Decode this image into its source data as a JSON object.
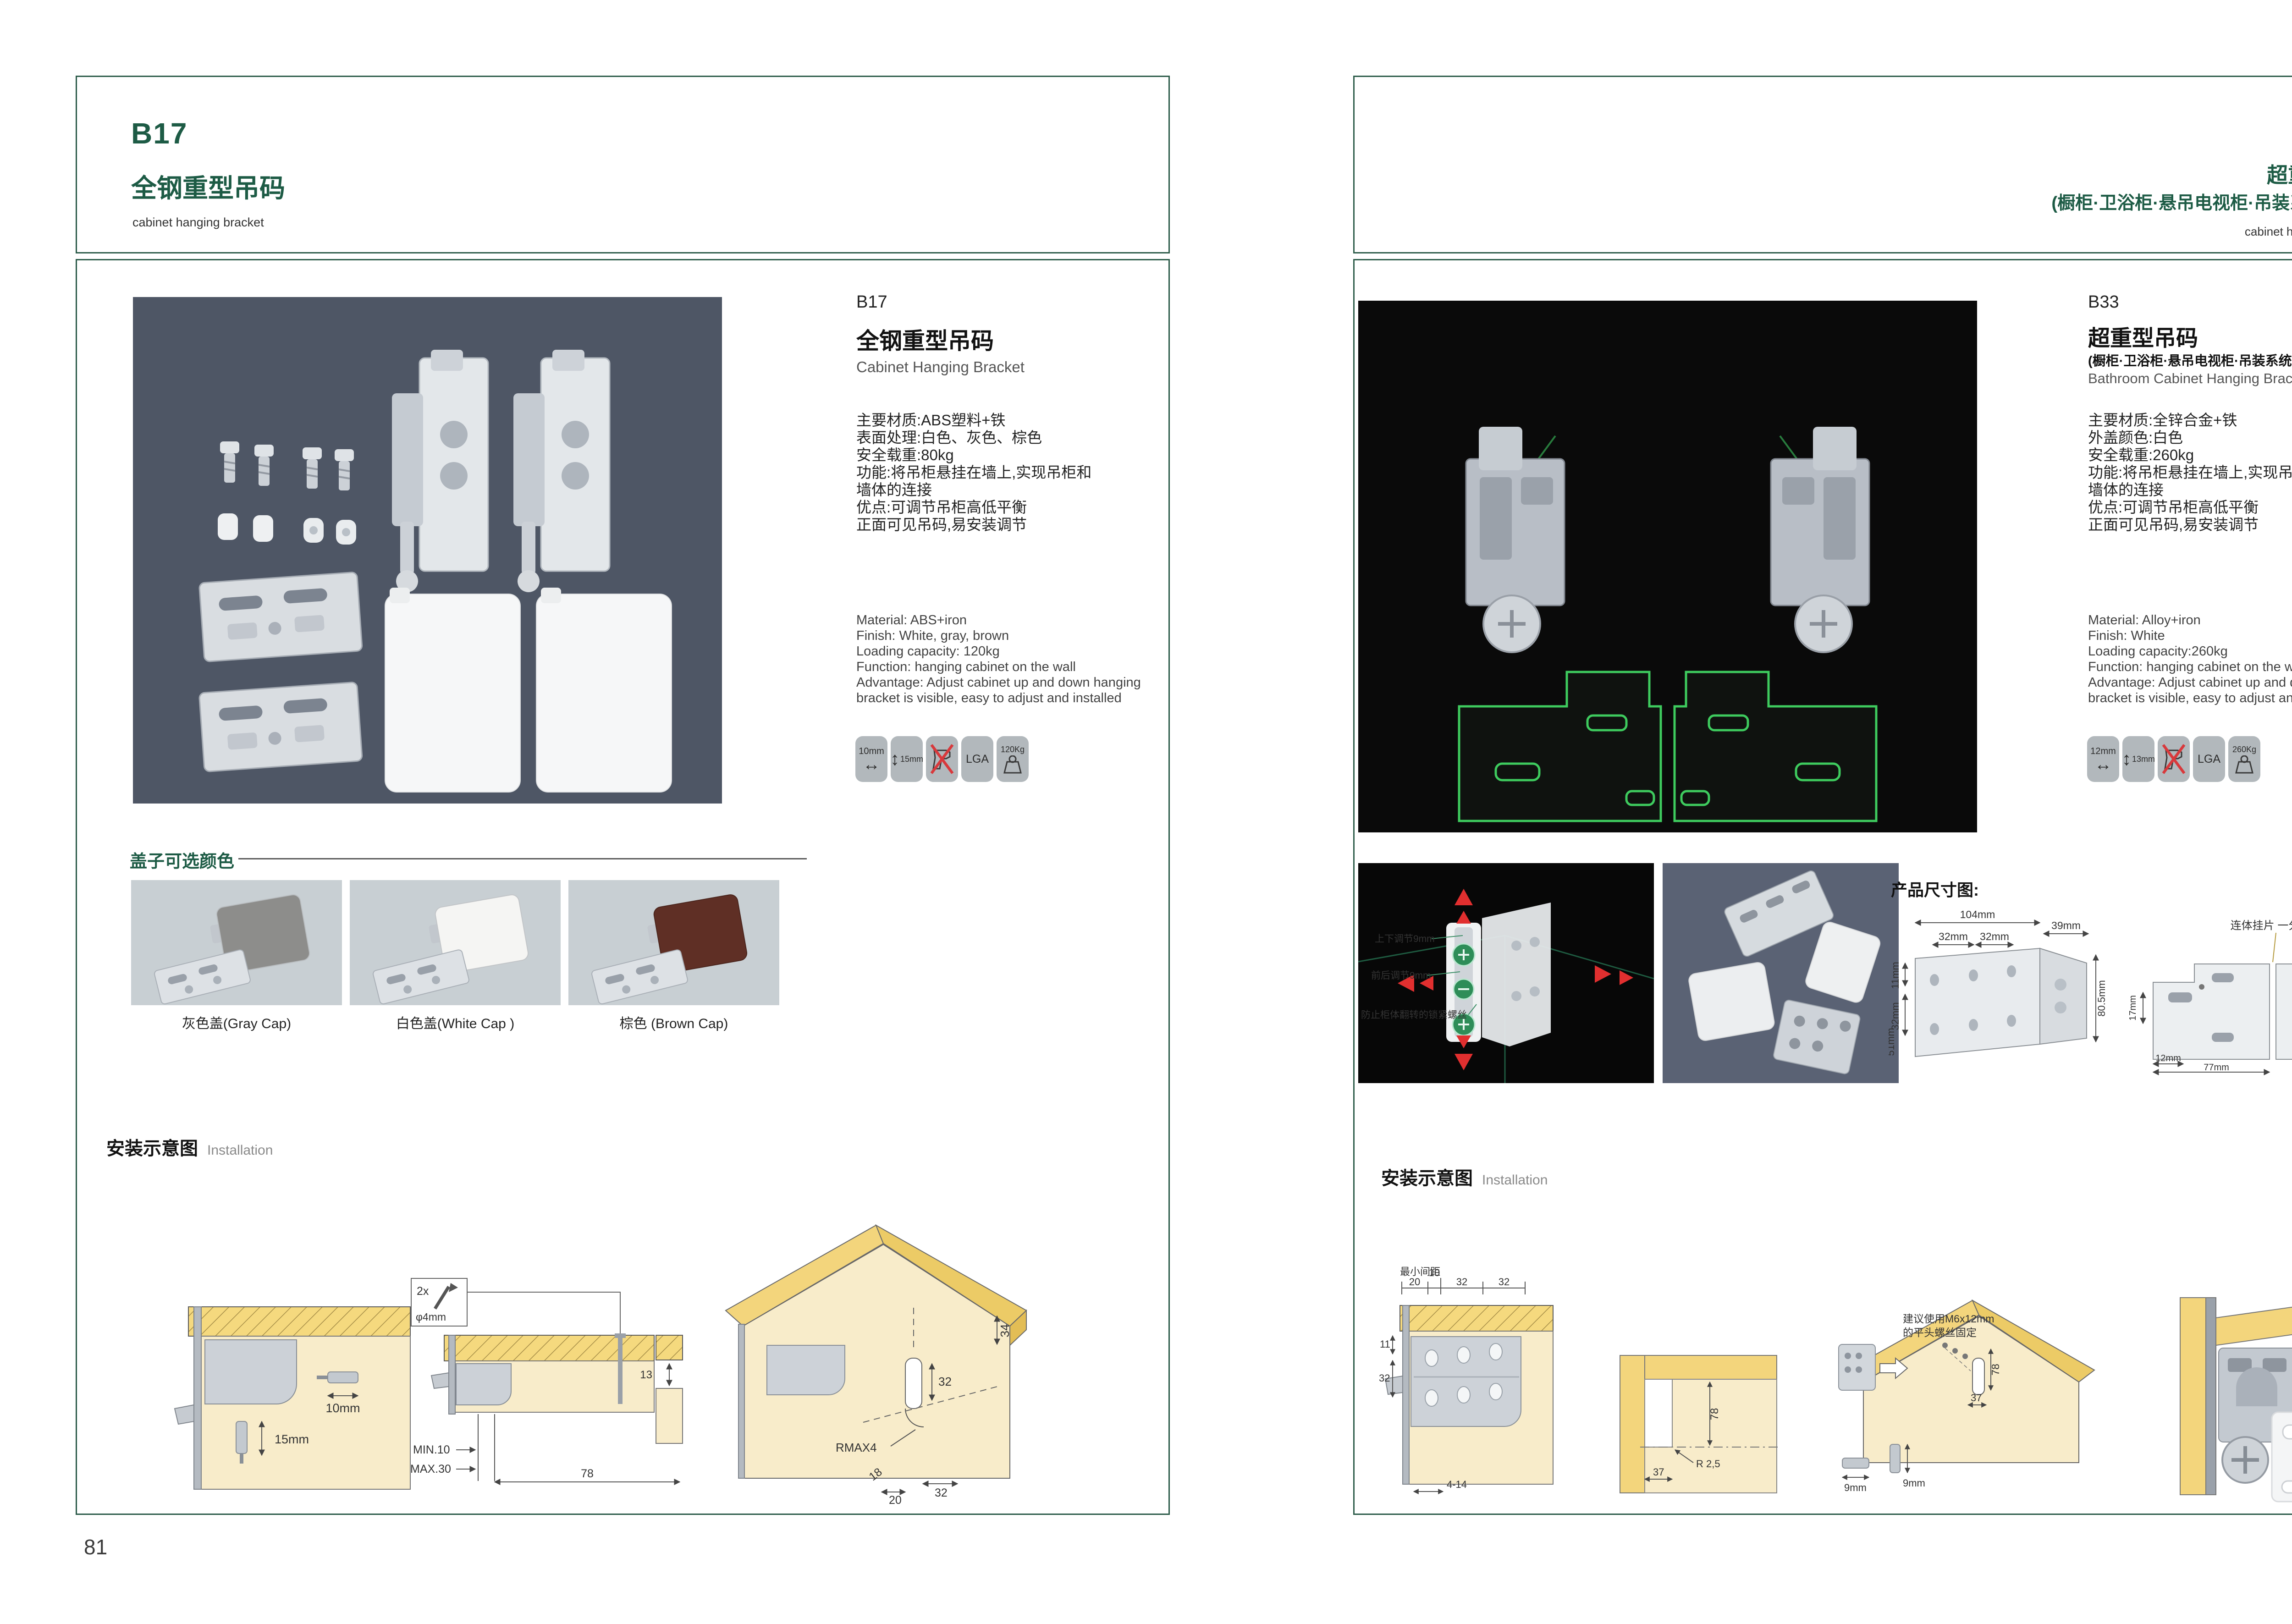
{
  "left_page": {
    "header": {
      "code": "B17",
      "title_zh": "全钢重型吊码",
      "subtitle_en": "cabinet hanging bracket"
    },
    "product": {
      "code": "B17",
      "name_zh": "全钢重型吊码",
      "name_en": "Cabinet Hanging Bracket",
      "specs_zh": [
        "主要材质:ABS塑料+铁",
        "表面处理:白色、灰色、棕色",
        "安全载重:80kg",
        "功能:将吊柜悬挂在墙上,实现吊柜和",
        "墙体的连接",
        "优点:可调节吊柜高低平衡",
        "正面可见吊码,易安装调节"
      ],
      "specs_en": [
        "Material: ABS+iron",
        "Finish: White, gray, brown",
        "Loading capacity: 120kg",
        "Function: hanging cabinet on the wall",
        "Advantage: Adjust cabinet up and down hanging",
        "bracket is visible, easy to adjust and installed"
      ],
      "badges": {
        "width": "10mm",
        "height": "15mm",
        "cert": "LGA",
        "load": "120Kg"
      }
    },
    "cap_options": {
      "title": "盖子可选颜色",
      "items": [
        {
          "label": "灰色盖(Gray Cap)",
          "color": "#8d8d8b"
        },
        {
          "label": "白色盖(White Cap )",
          "color": "#f5f5f3"
        },
        {
          "label": "棕色 (Brown Cap)",
          "color": "#5f2f25"
        }
      ]
    },
    "installation": {
      "title_zh": "安装示意图",
      "title_en": "Installation",
      "d1": {
        "width": "10mm",
        "height": "15mm"
      },
      "d2": {
        "qty": "2x",
        "diameter": "φ4mm",
        "depth": "13",
        "min": "MIN.10",
        "max": "MAX.30",
        "span": "78"
      },
      "d3": {
        "top": "34",
        "mid": "32",
        "radius": "RMAX4",
        "a": "18",
        "b": "20",
        "c": "32"
      }
    },
    "page_number": "81"
  },
  "right_page": {
    "header": {
      "code": "B33",
      "title_zh": "超重型吊码",
      "title_zh2": "(橱柜·卫浴柜·悬吊电视柜·吊装系统 专用)",
      "subtitle_en": "cabinet hanging bracket"
    },
    "product": {
      "code": "B33",
      "name_zh": "超重型吊码",
      "name_zh2": "(橱柜·卫浴柜·悬吊电视柜·吊装系统 专用)",
      "name_en": "Bathroom Cabinet Hanging Bracket",
      "specs_zh": [
        "主要材质:全锌合金+铁",
        "外盖颜色:白色",
        "安全载重:260kg",
        "功能:将吊柜悬挂在墙上,实现吊柜和",
        "墙体的连接",
        "优点:可调节吊柜高低平衡",
        "正面可见吊码,易安装调节"
      ],
      "specs_en": [
        "Material: Alloy+iron",
        "Finish: White",
        "Loading capacity:260kg",
        "Function: hanging cabinet on the wall",
        "Advantage: Adjust cabinet up and down hanging",
        "bracket is visible, easy to adjust and installed"
      ],
      "badges": {
        "width": "12mm",
        "height": "13mm",
        "cert": "LGA",
        "load": "260Kg"
      }
    },
    "detail_photo": {
      "labels": [
        "上下调节9mm",
        "前后调节9mm",
        "防止柜体翻转的锁紧螺丝"
      ]
    },
    "dimensions": {
      "title": "产品尺寸图:",
      "bracket": {
        "a": "104mm",
        "b": "39mm",
        "c": "32mm",
        "d": "32mm",
        "e": "11mm",
        "f": "32mm",
        "g": "51mm",
        "h": "80.5mm"
      },
      "plate": {
        "label": "连体挂片 一分为二",
        "a": "55mm",
        "b": "39mm",
        "c": "55mm",
        "d": "8mm",
        "e": "17mm",
        "f": "12mm",
        "g": "63mm",
        "h": "77mm"
      }
    },
    "installation": {
      "title_zh": "安装示意图",
      "title_en": "Installation",
      "d1": {
        "min_label": "最小间距",
        "a": "20",
        "b": "10",
        "c": "32",
        "d": "32",
        "e": "11",
        "f": "32",
        "g": "4-14"
      },
      "d2": {
        "a": "78",
        "b": "R 2,5",
        "c": "37"
      },
      "d3": {
        "note1": "建议使用M6x12mm",
        "note2": "的平头螺丝固定",
        "a": "78",
        "b": "37",
        "c": "9mm",
        "d": "9mm"
      }
    },
    "page_number": "82"
  }
}
